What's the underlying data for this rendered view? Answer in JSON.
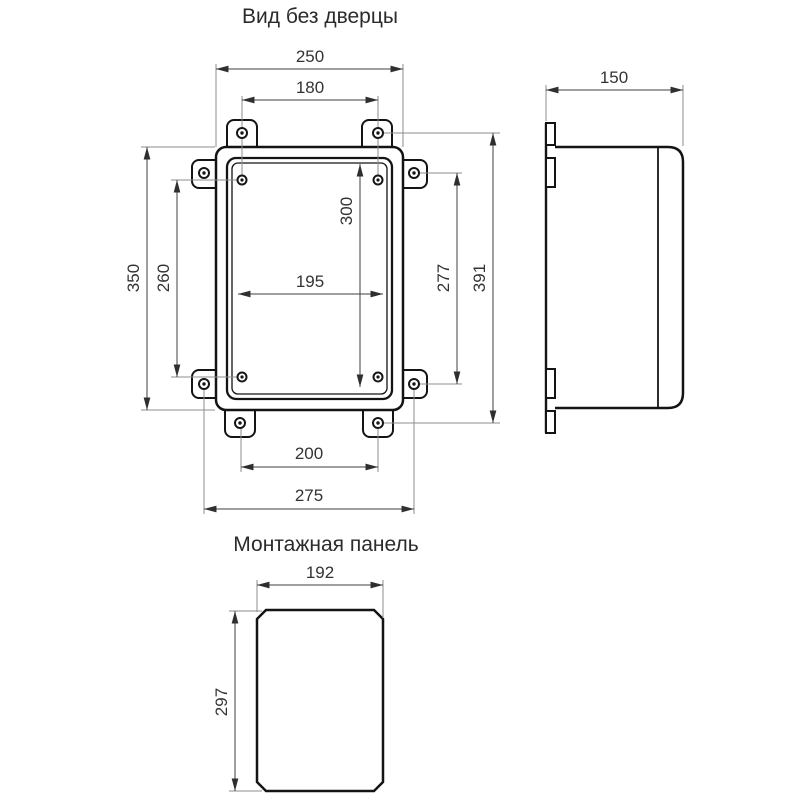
{
  "drawing": {
    "background": "#ffffff",
    "line_color": "#141414",
    "dim_color": "#3f3f3f",
    "ext_line_color": "#8d8d8d",
    "views": {
      "front": {
        "title": "Вид без дверцы",
        "dims": {
          "overall_width": "250",
          "top_hole_spacing": "180",
          "overall_height": "350",
          "panel_hole_spacing_v": "260",
          "inner_width": "195",
          "inner_height": "300",
          "side_hole_spacing_v": "277",
          "lug_hole_span_v": "391",
          "bottom_hole_spacing": "200",
          "side_lug_span": "275"
        }
      },
      "side": {
        "dims": {
          "depth": "150"
        }
      },
      "panel": {
        "title": "Монтажная панель",
        "dims": {
          "width": "192",
          "height": "297"
        }
      }
    }
  }
}
